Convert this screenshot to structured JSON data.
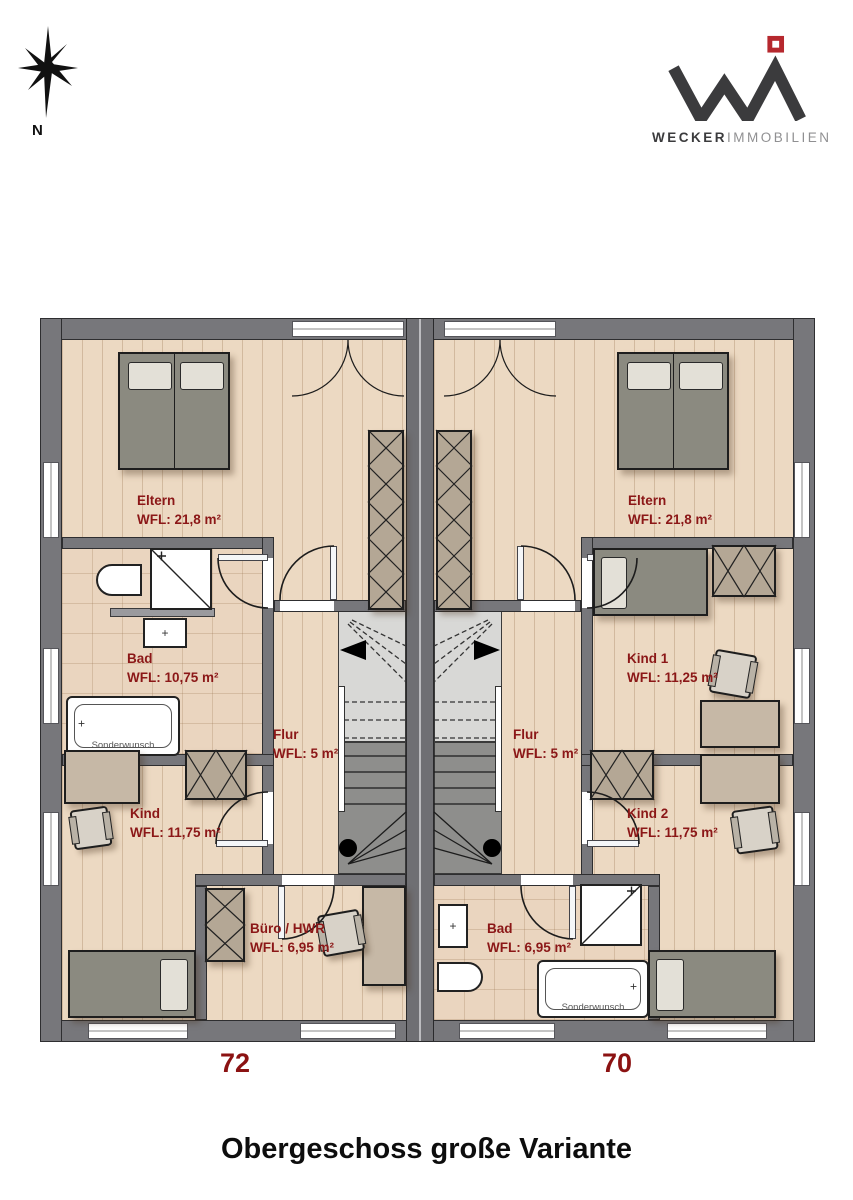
{
  "title": "Obergeschoss große Variante",
  "compass": {
    "label": "N"
  },
  "logo": {
    "word_bold": "WECKER",
    "word_light": "IMMOBILIEN"
  },
  "units": {
    "left": "72",
    "right": "70"
  },
  "rooms": {
    "eltern_left": {
      "name": "Eltern",
      "area": "WFL: 21,8 m²"
    },
    "eltern_right": {
      "name": "Eltern",
      "area": "WFL: 21,8 m²"
    },
    "bad_left": {
      "name": "Bad",
      "area": "WFL: 10,75 m²"
    },
    "kind1_right": {
      "name": "Kind 1",
      "area": "WFL: 11,25 m²"
    },
    "flur_left": {
      "name": "Flur",
      "area": "WFL: 5 m²"
    },
    "flur_right": {
      "name": "Flur",
      "area": "WFL: 5 m²"
    },
    "kind_left": {
      "name": "Kind",
      "area": "WFL: 11,75 m²"
    },
    "kind2_right": {
      "name": "Kind 2",
      "area": "WFL: 11,75 m²"
    },
    "buero_left": {
      "name": "Büro / HWR",
      "area": "WFL: 6,95 m²"
    },
    "bad_right": {
      "name": "Bad",
      "area": "WFL: 6,95 m²"
    }
  },
  "fixtures": {
    "bathtub_option": "Sonderwunsch",
    "plus_mark": "+"
  },
  "colors": {
    "label_red": "#8b1717",
    "unit_number_red": "#8b1212",
    "wall_gray": "#77777b",
    "floor_wood": "#ecd9c2",
    "floor_tile": "#ead5bf",
    "stair_light": "#d8d8d6",
    "stair_dark": "#8e8e8c",
    "logo_dark": "#3b3b3d",
    "logo_red": "#b6282e"
  }
}
